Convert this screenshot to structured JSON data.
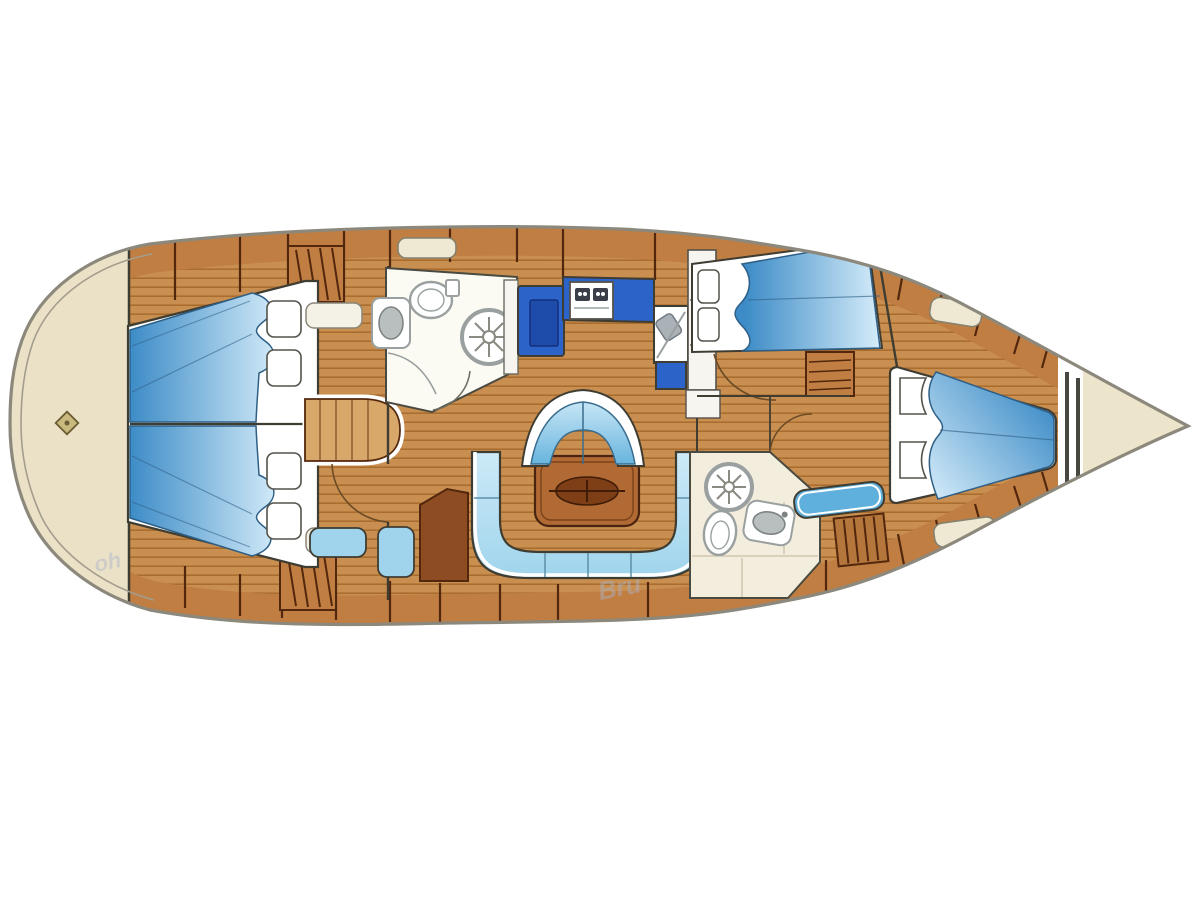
{
  "diagram": {
    "type": "sailing-yacht-interior-floorplan",
    "description": "Top-down layout plan of a sailing yacht, bow pointing right",
    "regions": [
      "stern-locker-left",
      "full-beam-aft-cabin",
      "mid-head-top",
      "galley",
      "salon",
      "nav-station",
      "guest-cabin-top-right",
      "head-bottom-right",
      "forward-cabin-right",
      "bow-locker-right"
    ],
    "furniture": [
      "v-berth-double-bed-left",
      "pillows",
      "vanity-table",
      "louvered-lockers",
      "toilet",
      "washbasin",
      "shower",
      "stove-two-burner",
      "galley-sink",
      "salon-table-with-compass-inlay",
      "curved-settee",
      "u-shaped-sofa",
      "chart-table",
      "nav-seat",
      "wardrobe",
      "double-bed-aft-top",
      "double-bed-forward",
      "companionway-steps",
      "bench-cushion",
      "deck-hatches",
      "bow-deck-fitting"
    ]
  },
  "watermark": {
    "left": "oh",
    "center": "Bru"
  },
  "palette": {
    "hull-outline": "#8c887c",
    "hull-inner-line": "#a39d8d",
    "cream": "#eae1c6",
    "stern-cream": "#ece4cb",
    "wood-floor": "#c98f50",
    "wood-line": "#a86d2f",
    "wood-cabinet": "#c07e42",
    "seam": "#53270d",
    "outline": "#3f3c32",
    "blue-counter": "#2c63c8",
    "blue-counter-dark": "#1d4cab",
    "stove-dark": "#3a3f4a",
    "upholstery-light": "#d8effa",
    "upholstery-mid": "#9fd4ec",
    "upholstery-deep": "#5fb0dc",
    "duvet-deep": "#3d8cc7",
    "duvet-light": "#d5ecf9",
    "white": "#ffffff",
    "room-white": "#fbfaf3",
    "tile-cream": "#f3eddd",
    "fixture": "#9aa0a0",
    "table-wood": "#b26a35",
    "table-inlay": "#7e3f17",
    "chart-table": "#8d4c22",
    "vanity": "#d8a86a",
    "hatch": "#efe8d2",
    "watermark": "#aab4cc"
  }
}
